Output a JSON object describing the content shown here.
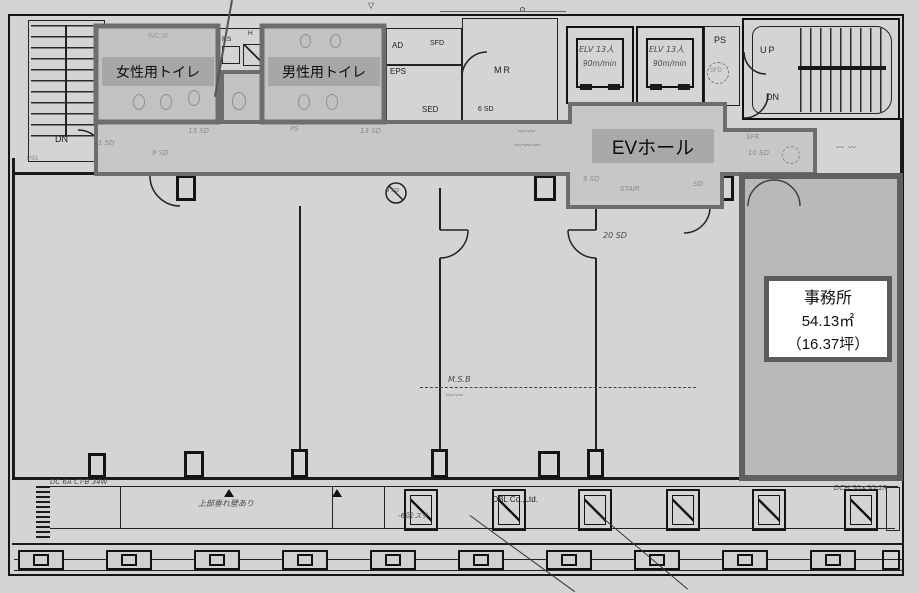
{
  "rooms": {
    "womens_toilet": "女性用トイレ",
    "mens_toilet": "男性用トイレ",
    "ev_hall": "EVホール",
    "office_name": "事務所",
    "office_area_m2": "54.13㎡",
    "office_area_tsubo": "（16.37坪）"
  },
  "labels": {
    "wc_w": "WC.W",
    "fs": "F.S",
    "h": "H",
    "ad": "AD",
    "sfd_top": "SFD",
    "eps": "EPS",
    "sed": "SED",
    "mr": "MR",
    "sd6": "6 SD",
    "elv": "ELV 13人",
    "elv_speed": "90m/min",
    "ps": "PS",
    "sfd_shaft": "SFD",
    "up": "UP",
    "dn_right": "DN",
    "dn_left": "DN",
    "ps1": "PS1"
  },
  "corridor": {
    "sd1": "1 SD",
    "sd9": "9 SD",
    "sd13a": "13 SD",
    "ps": "PS",
    "sd13b": "13 SD",
    "sd9_hall": "9 SD",
    "stair": "STAIR",
    "sd_hall": "SD",
    "sfr": "SFR",
    "sd10": "10 SD"
  },
  "annotations": {
    "sd20": "20 SD",
    "msb": "M.S.B",
    "vent": "9 SD",
    "obl": "OBL Co.,Ltd.",
    "dc_note": "DC 6A CT-B 34W",
    "wall_note": "上部垂れ壁あり",
    "kai_note": "-6回:スチ",
    "dch_note": "DCH 50×50-1R"
  }
}
